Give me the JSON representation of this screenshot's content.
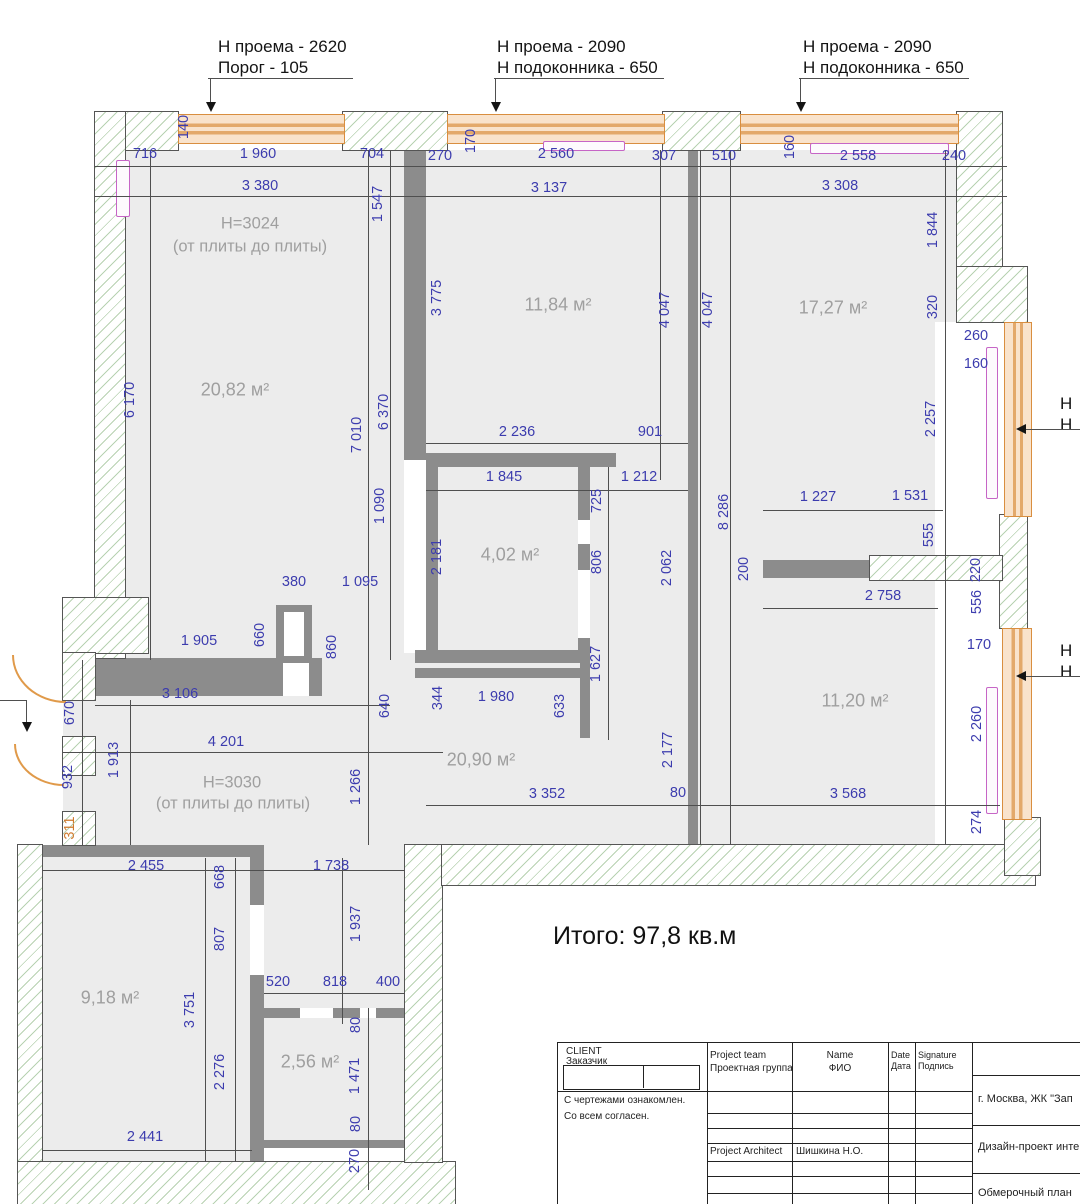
{
  "annotations": {
    "top": [
      {
        "line1": "Н проема - 2620",
        "line2": "Порог - 105"
      },
      {
        "line1": "Н проема - 2090",
        "line2": "Н подоконника - 650"
      },
      {
        "line1": "Н проема - 2090",
        "line2": "Н подоконника - 650"
      }
    ],
    "right_edge": [
      {
        "line1": "Н",
        "line2": "Н"
      },
      {
        "line1": "Н",
        "line2": "Н"
      }
    ],
    "total": "Итого: 97,8 кв.м"
  },
  "rooms": {
    "room1": {
      "area": "20,82 м²",
      "height_note1": "Н=3024",
      "height_note2": "(от плиты до плиты)"
    },
    "room2": {
      "area": "11,84 м²"
    },
    "room3": {
      "area": "17,27 м²"
    },
    "room4": {
      "area": "4,02 м²"
    },
    "hall": {
      "area": "20,90 м²",
      "height_note1": "Н=3030",
      "height_note2": "(от плиты до плиты)"
    },
    "room5": {
      "area": "11,20 м²"
    },
    "room6": {
      "area": "9,18 м²"
    },
    "room7": {
      "area": "2,56 м²"
    }
  },
  "dimensions": [
    {
      "v": "716",
      "x": 145,
      "y": 154,
      "o": "h"
    },
    {
      "v": "1 960",
      "x": 258,
      "y": 154,
      "o": "h"
    },
    {
      "v": "704",
      "x": 372,
      "y": 154,
      "o": "h"
    },
    {
      "v": "270",
      "x": 440,
      "y": 156,
      "o": "h"
    },
    {
      "v": "140",
      "x": 184,
      "y": 127,
      "o": "v"
    },
    {
      "v": "170",
      "x": 471,
      "y": 141,
      "o": "v"
    },
    {
      "v": "2 560",
      "x": 556,
      "y": 154,
      "o": "h"
    },
    {
      "v": "307",
      "x": 664,
      "y": 156,
      "o": "h"
    },
    {
      "v": "510",
      "x": 724,
      "y": 156,
      "o": "h"
    },
    {
      "v": "160",
      "x": 790,
      "y": 147,
      "o": "v"
    },
    {
      "v": "2 558",
      "x": 858,
      "y": 156,
      "o": "h"
    },
    {
      "v": "240",
      "x": 954,
      "y": 156,
      "o": "h"
    },
    {
      "v": "3 380",
      "x": 260,
      "y": 186,
      "o": "h"
    },
    {
      "v": "3 137",
      "x": 549,
      "y": 188,
      "o": "h"
    },
    {
      "v": "3 308",
      "x": 840,
      "y": 186,
      "o": "h"
    },
    {
      "v": "1 547",
      "x": 378,
      "y": 204,
      "o": "v"
    },
    {
      "v": "3 775",
      "x": 437,
      "y": 298,
      "o": "v"
    },
    {
      "v": "4 047",
      "x": 665,
      "y": 310,
      "o": "v"
    },
    {
      "v": "4 047",
      "x": 708,
      "y": 310,
      "o": "v"
    },
    {
      "v": "1 844",
      "x": 933,
      "y": 230,
      "o": "v"
    },
    {
      "v": "320",
      "x": 933,
      "y": 307,
      "o": "v"
    },
    {
      "v": "260",
      "x": 976,
      "y": 336,
      "o": "h"
    },
    {
      "v": "160",
      "x": 976,
      "y": 364,
      "o": "h"
    },
    {
      "v": "2 257",
      "x": 931,
      "y": 419,
      "o": "v"
    },
    {
      "v": "555",
      "x": 929,
      "y": 535,
      "o": "v"
    },
    {
      "v": "6 170",
      "x": 130,
      "y": 400,
      "o": "v"
    },
    {
      "v": "7 010",
      "x": 357,
      "y": 435,
      "o": "v"
    },
    {
      "v": "6 370",
      "x": 384,
      "y": 412,
      "o": "v"
    },
    {
      "v": "1 090",
      "x": 380,
      "y": 506,
      "o": "v"
    },
    {
      "v": "2 181",
      "x": 437,
      "y": 557,
      "o": "v"
    },
    {
      "v": "2 236",
      "x": 517,
      "y": 432,
      "o": "h"
    },
    {
      "v": "901",
      "x": 650,
      "y": 432,
      "o": "h"
    },
    {
      "v": "1 845",
      "x": 504,
      "y": 477,
      "o": "h"
    },
    {
      "v": "1 212",
      "x": 639,
      "y": 477,
      "o": "h"
    },
    {
      "v": "725",
      "x": 597,
      "y": 501,
      "o": "v"
    },
    {
      "v": "806",
      "x": 597,
      "y": 562,
      "o": "v"
    },
    {
      "v": "1 627",
      "x": 596,
      "y": 664,
      "o": "v"
    },
    {
      "v": "2 062",
      "x": 667,
      "y": 568,
      "o": "v"
    },
    {
      "v": "8 286",
      "x": 724,
      "y": 512,
      "o": "v"
    },
    {
      "v": "1 227",
      "x": 818,
      "y": 497,
      "o": "h"
    },
    {
      "v": "1 531",
      "x": 910,
      "y": 496,
      "o": "h"
    },
    {
      "v": "200",
      "x": 744,
      "y": 569,
      "o": "v"
    },
    {
      "v": "2 758",
      "x": 883,
      "y": 596,
      "o": "h"
    },
    {
      "v": "220",
      "x": 976,
      "y": 570,
      "o": "v"
    },
    {
      "v": "556",
      "x": 977,
      "y": 602,
      "o": "v"
    },
    {
      "v": "170",
      "x": 979,
      "y": 645,
      "o": "h"
    },
    {
      "v": "2 260",
      "x": 977,
      "y": 724,
      "o": "v"
    },
    {
      "v": "380",
      "x": 294,
      "y": 582,
      "o": "h"
    },
    {
      "v": "1 095",
      "x": 360,
      "y": 582,
      "o": "h"
    },
    {
      "v": "660",
      "x": 260,
      "y": 635,
      "o": "v"
    },
    {
      "v": "860",
      "x": 332,
      "y": 647,
      "o": "v"
    },
    {
      "v": "1 905",
      "x": 199,
      "y": 641,
      "o": "h"
    },
    {
      "v": "3 106",
      "x": 180,
      "y": 694,
      "o": "h"
    },
    {
      "v": "4 201",
      "x": 226,
      "y": 742,
      "o": "h"
    },
    {
      "v": "640",
      "x": 385,
      "y": 706,
      "o": "v"
    },
    {
      "v": "344",
      "x": 438,
      "y": 698,
      "o": "v"
    },
    {
      "v": "1 980",
      "x": 496,
      "y": 697,
      "o": "h"
    },
    {
      "v": "633",
      "x": 560,
      "y": 706,
      "o": "v"
    },
    {
      "v": "670",
      "x": 70,
      "y": 713,
      "o": "v"
    },
    {
      "v": "932",
      "x": 68,
      "y": 777,
      "o": "v"
    },
    {
      "v": "311",
      "x": 70,
      "y": 828,
      "o": "v",
      "c": "#cf7a2e"
    },
    {
      "v": "1 913",
      "x": 114,
      "y": 760,
      "o": "v"
    },
    {
      "v": "1 266",
      "x": 356,
      "y": 787,
      "o": "v"
    },
    {
      "v": "2 177",
      "x": 668,
      "y": 750,
      "o": "v"
    },
    {
      "v": "3 352",
      "x": 547,
      "y": 794,
      "o": "h"
    },
    {
      "v": "80",
      "x": 678,
      "y": 793,
      "o": "h"
    },
    {
      "v": "3 568",
      "x": 848,
      "y": 794,
      "o": "h"
    },
    {
      "v": "274",
      "x": 977,
      "y": 822,
      "o": "v"
    },
    {
      "v": "2 455",
      "x": 146,
      "y": 866,
      "o": "h"
    },
    {
      "v": "668",
      "x": 220,
      "y": 877,
      "o": "v"
    },
    {
      "v": "1 738",
      "x": 331,
      "y": 866,
      "o": "h"
    },
    {
      "v": "807",
      "x": 220,
      "y": 939,
      "o": "v"
    },
    {
      "v": "1 937",
      "x": 356,
      "y": 924,
      "o": "v"
    },
    {
      "v": "3 751",
      "x": 190,
      "y": 1010,
      "o": "v"
    },
    {
      "v": "520",
      "x": 278,
      "y": 982,
      "o": "h"
    },
    {
      "v": "818",
      "x": 335,
      "y": 982,
      "o": "h"
    },
    {
      "v": "400",
      "x": 388,
      "y": 982,
      "o": "h"
    },
    {
      "v": "2 276",
      "x": 220,
      "y": 1072,
      "o": "v"
    },
    {
      "v": "80",
      "x": 356,
      "y": 1025,
      "o": "v"
    },
    {
      "v": "1 471",
      "x": 355,
      "y": 1076,
      "o": "v"
    },
    {
      "v": "80",
      "x": 356,
      "y": 1124,
      "o": "v"
    },
    {
      "v": "270",
      "x": 355,
      "y": 1161,
      "o": "v"
    },
    {
      "v": "2 441",
      "x": 145,
      "y": 1137,
      "o": "h"
    }
  ],
  "title_block": {
    "client_label_en": "CLIENT",
    "client_label_ru": "Заказчик",
    "agree_line1": "С чертежами ознакомлен.",
    "agree_line2": "Со всем согласен.",
    "col_team_en": "Project team",
    "col_team_ru": "Проектная группа",
    "col_name_en": "Name",
    "col_name_ru": "ФИО",
    "col_date_en": "Date",
    "col_date_ru": "Дата",
    "col_sign_en": "Signature",
    "col_sign_ru": "Подпись",
    "architect_role": "Project Architect",
    "architect_name": "Шишкина Н.О.",
    "project_location": "г. Москва, ЖК \"Зап",
    "project_name": "Дизайн-проект инте",
    "sheet_name": "Обмерочный план"
  }
}
